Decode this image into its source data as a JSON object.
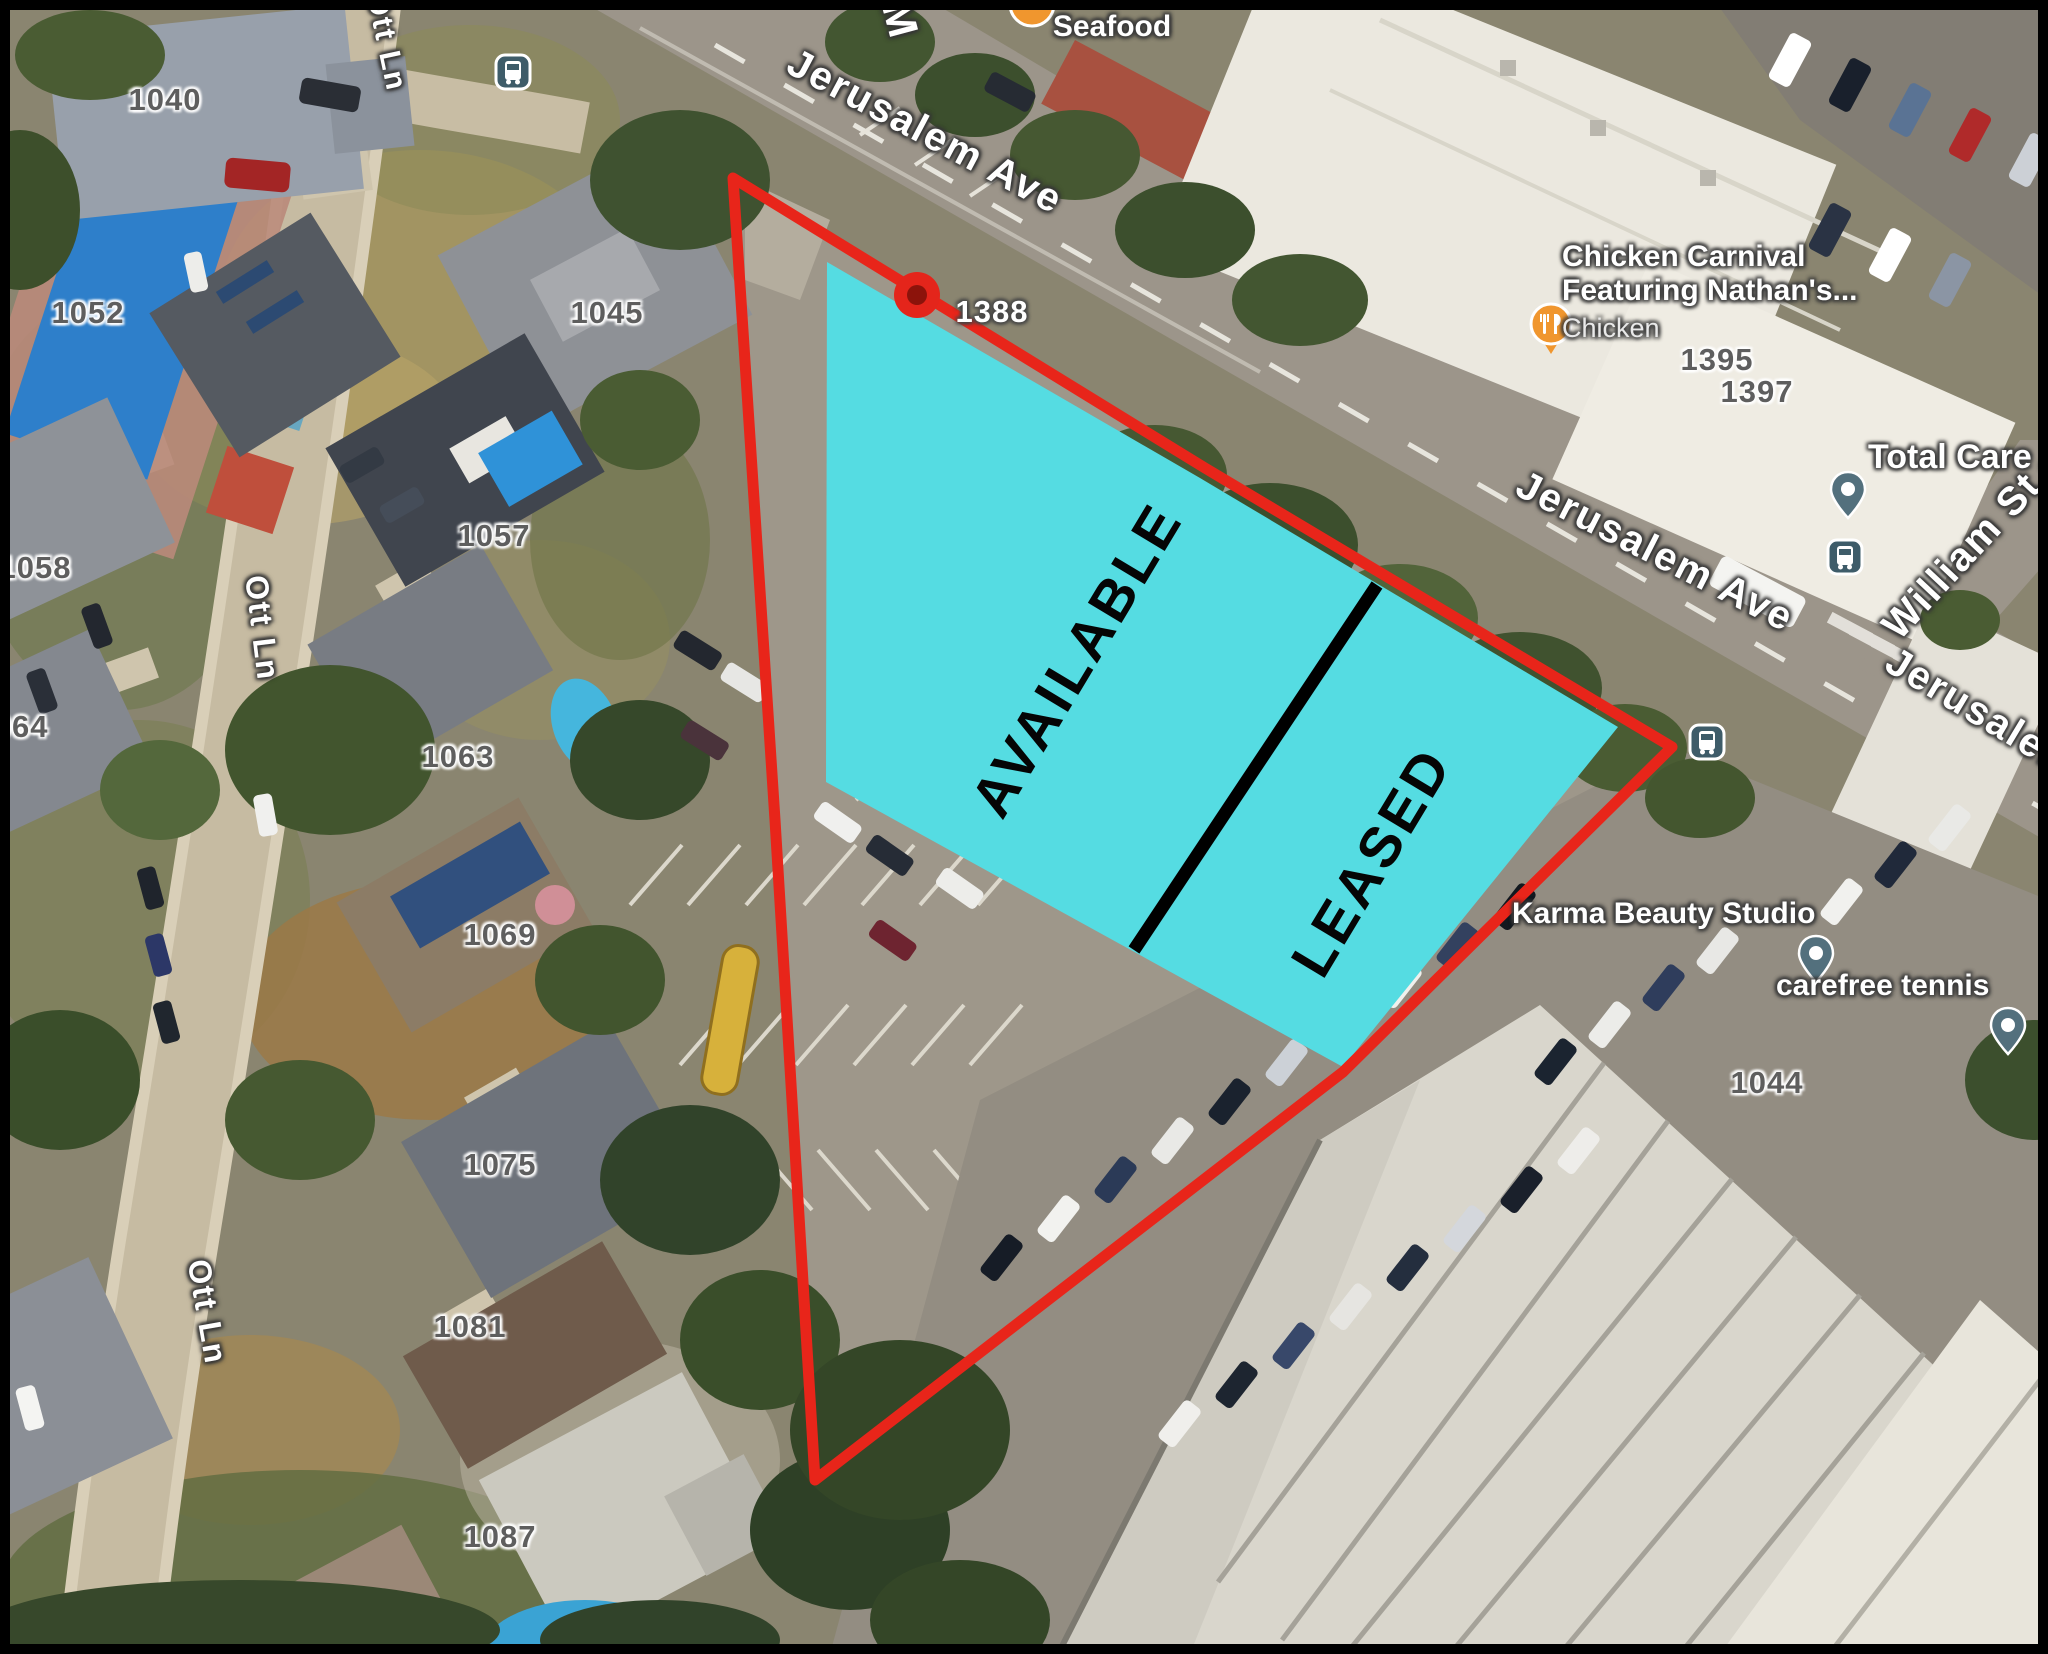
{
  "overlay": {
    "available_label": "AVAILABLE",
    "leased_label": "LEASED",
    "marker_address": "1388",
    "highlight_color": "#55dce2",
    "boundary_color": "#e8251a",
    "divider_color": "#000000"
  },
  "streets": [
    {
      "name": "Jerusalem Ave"
    },
    {
      "name": "Jerusalem Ave"
    },
    {
      "name": "Jerusalem Ave"
    },
    {
      "name": "William St"
    },
    {
      "name": "Ott Ln"
    },
    {
      "name": "Ott Ln"
    },
    {
      "name": "Ott Ln"
    },
    {
      "name": "M"
    }
  ],
  "addresses": [
    {
      "number": "1040"
    },
    {
      "number": "1052"
    },
    {
      "number": "1045"
    },
    {
      "number": "1057"
    },
    {
      "number": "1058"
    },
    {
      "number": "1063"
    },
    {
      "number": "1064"
    },
    {
      "number": "1069"
    },
    {
      "number": "1075"
    },
    {
      "number": "1081"
    },
    {
      "number": "1087"
    },
    {
      "number": "1395"
    },
    {
      "number": "1397"
    },
    {
      "number": "1044"
    }
  ],
  "pois": {
    "seafood": {
      "name": "Seafood"
    },
    "chicken_carnival": {
      "line1": "Chicken Carnival",
      "line2": "Featuring Nathan's...",
      "category": "Chicken"
    },
    "total_care": {
      "name": "Total Care Ad"
    },
    "karma": {
      "name": "Karma Beauty Studio"
    },
    "carefree": {
      "name": "carefree tennis"
    }
  }
}
